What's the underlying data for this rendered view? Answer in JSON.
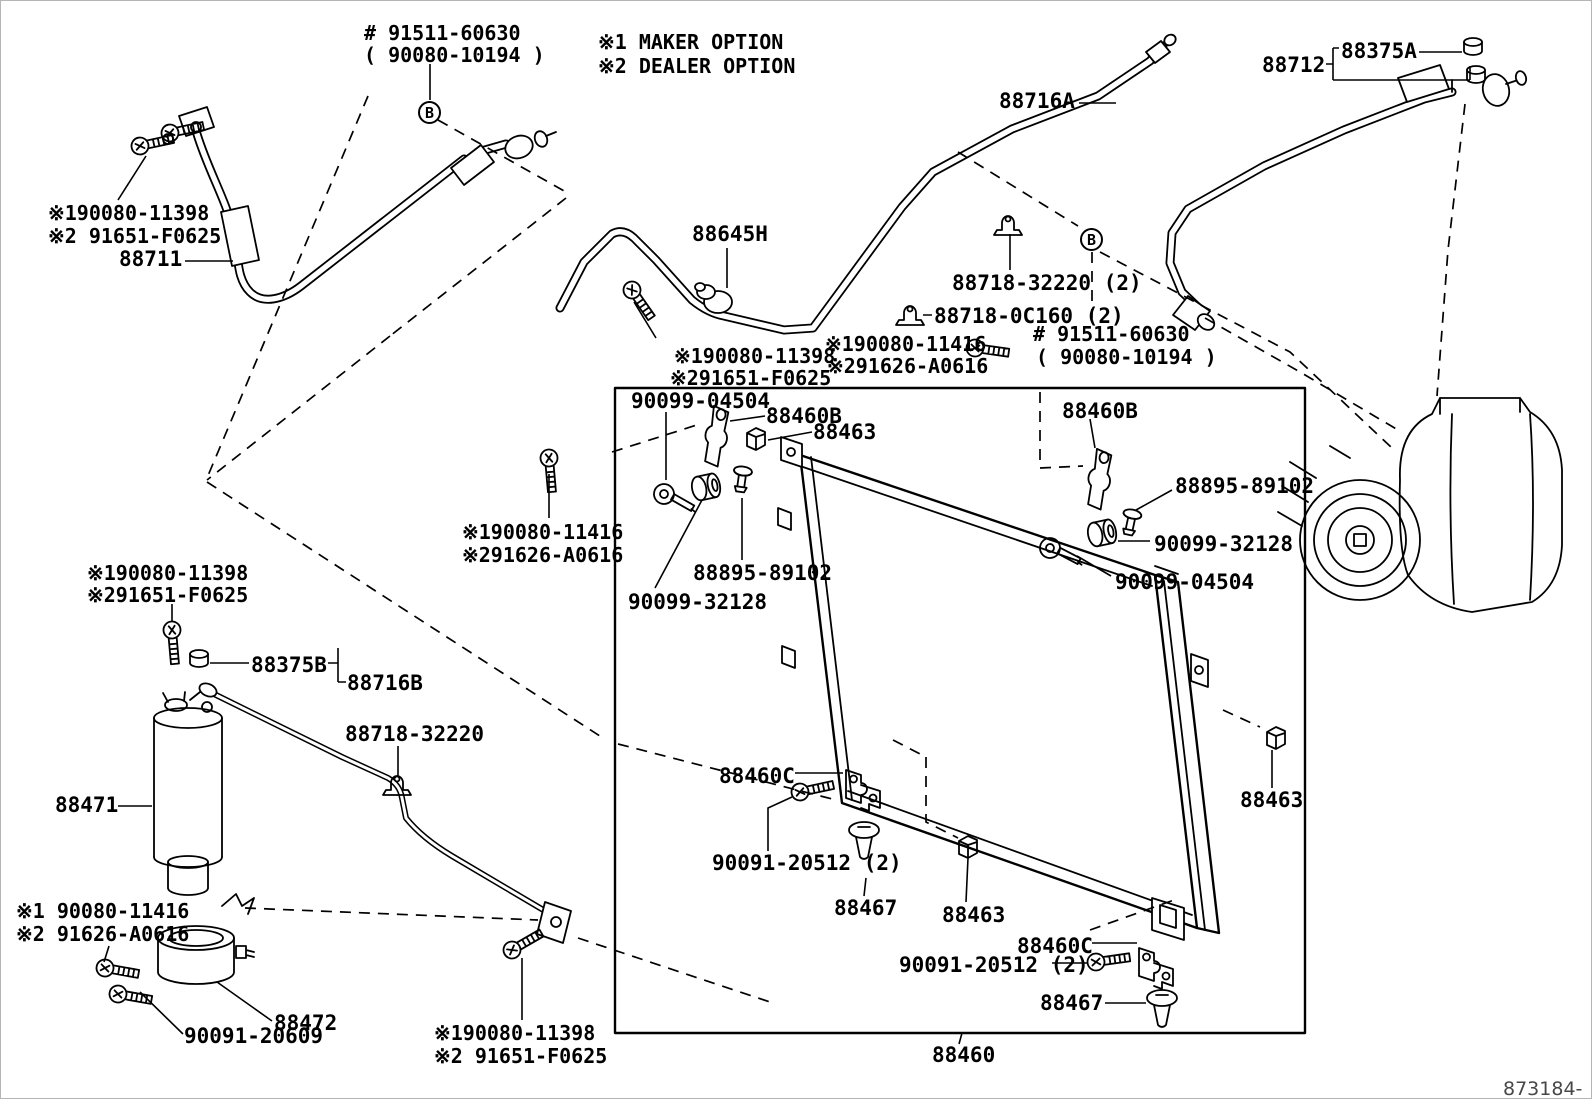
{
  "diagram": {
    "doc_number": "873184- E",
    "legend": {
      "maker": "※1 MAKER OPTION",
      "dealer": "※2 DEALER OPTION"
    },
    "connector_markers": [
      "B",
      "B"
    ],
    "labels": [
      {
        "id": "91511-60630-top",
        "text": "# 91511-60630"
      },
      {
        "id": "90080-10194-top",
        "text": "( 90080-10194 )"
      },
      {
        "id": "88712",
        "text": "88712"
      },
      {
        "id": "88375A",
        "text": "88375A"
      },
      {
        "id": "88716A",
        "text": "88716A"
      },
      {
        "id": "note-11398-a1",
        "text": "※190080-11398"
      },
      {
        "id": "note-f0625-a2",
        "text": "※2 91651-F0625"
      },
      {
        "id": "88711",
        "text": "88711"
      },
      {
        "id": "88645H",
        "text": "88645H"
      },
      {
        "id": "88718-32220-x2",
        "text": "88718-32220 (2)"
      },
      {
        "id": "88718-0C160-x2",
        "text": "88718-0C160 (2)"
      },
      {
        "id": "note-11398-b1",
        "text": "※190080-11398"
      },
      {
        "id": "note-f0625-b2",
        "text": "※291651-F0625"
      },
      {
        "id": "note-11416-a1",
        "text": "※190080-11416"
      },
      {
        "id": "note-a0616-a2",
        "text": "※291626-A0616"
      },
      {
        "id": "91511-60630-mid",
        "text": "# 91511-60630"
      },
      {
        "id": "90080-10194-mid",
        "text": "( 90080-10194 )"
      },
      {
        "id": "90099-04504-a",
        "text": "90099-04504"
      },
      {
        "id": "88460B-a",
        "text": "88460B"
      },
      {
        "id": "88463-a",
        "text": "88463"
      },
      {
        "id": "88460B-b",
        "text": "88460B"
      },
      {
        "id": "88895-89102-b",
        "text": "88895-89102"
      },
      {
        "id": "90099-32128-b",
        "text": "90099-32128"
      },
      {
        "id": "90099-04504-b",
        "text": "90099-04504"
      },
      {
        "id": "note-11416-b1",
        "text": "※190080-11416"
      },
      {
        "id": "note-a0616-b2",
        "text": "※291626-A0616"
      },
      {
        "id": "88895-89102-a",
        "text": "88895-89102"
      },
      {
        "id": "90099-32128-a",
        "text": "90099-32128"
      },
      {
        "id": "note-11398-c1",
        "text": "※190080-11398"
      },
      {
        "id": "note-f0625-c2",
        "text": "※291651-F0625"
      },
      {
        "id": "88375B",
        "text": "88375B"
      },
      {
        "id": "88716B",
        "text": "88716B"
      },
      {
        "id": "88718-32220",
        "text": "88718-32220"
      },
      {
        "id": "88471",
        "text": "88471"
      },
      {
        "id": "note-11416-c1",
        "text": "※1 90080-11416"
      },
      {
        "id": "note-a0616-c2",
        "text": "※2 91626-A0616"
      },
      {
        "id": "88472",
        "text": "88472"
      },
      {
        "id": "90091-20609",
        "text": "90091-20609"
      },
      {
        "id": "note-11398-d1",
        "text": "※190080-11398"
      },
      {
        "id": "note-f0625-d2",
        "text": "※2 91651-F0625"
      },
      {
        "id": "88460C-a",
        "text": "88460C"
      },
      {
        "id": "90091-20512-a",
        "text": "90091-20512 (2)"
      },
      {
        "id": "88467-a",
        "text": "88467"
      },
      {
        "id": "88463-b",
        "text": "88463"
      },
      {
        "id": "90091-20512-b",
        "text": "90091-20512 (2)"
      },
      {
        "id": "88460C-b",
        "text": "88460C"
      },
      {
        "id": "88467-b",
        "text": "88467"
      },
      {
        "id": "88463-c",
        "text": "88463"
      },
      {
        "id": "88460",
        "text": "88460"
      }
    ]
  }
}
